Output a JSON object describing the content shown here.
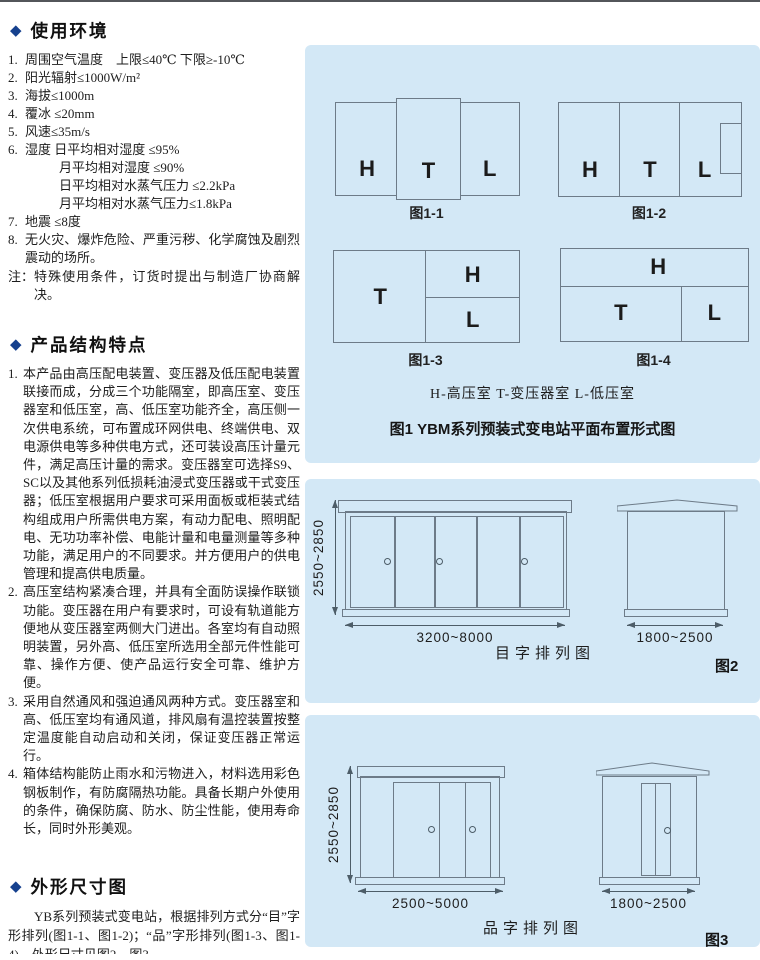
{
  "env": {
    "heading": "使用环境",
    "items": [
      {
        "no": "1.",
        "text": "周围空气温度　上限≤40℃ 下限≥-10℃"
      },
      {
        "no": "2.",
        "text": "阳光辐射≤1000W/m²"
      },
      {
        "no": "3.",
        "text": "海拔≤1000m"
      },
      {
        "no": "4.",
        "text": "覆冰 ≤20mm"
      },
      {
        "no": "5.",
        "text": "风速≤35m/s"
      },
      {
        "no": "6.",
        "text": "湿度 日平均相对湿度 ≤95%"
      },
      {
        "no": "",
        "text": "月平均相对湿度 ≤90%"
      },
      {
        "no": "",
        "text": "日平均相对水蒸气压力 ≤2.2kPa"
      },
      {
        "no": "",
        "text": "月平均相对水蒸气压力≤1.8kPa"
      },
      {
        "no": "7.",
        "text": "地震 ≤8度"
      },
      {
        "no": "8.",
        "text": "无火灾、爆炸危险、严重污秽、化学腐蚀及剧烈震动的场所。"
      }
    ],
    "note_label": "注：",
    "note_text": "特殊使用条件，订货时提出与制造厂协商解决。"
  },
  "features": {
    "heading": "产品结构特点",
    "items": [
      {
        "no": "1.",
        "text": "本产品由高压配电装置、变压器及低压配电装置联接而成，分成三个功能隔室，即高压室、变压器室和低压室，高、低压室功能齐全，高压侧一次供电系统，可布置成环网供电、终端供电、双电源供电等多种供电方式，还可装设高压计量元件，满足高压计量的需求。变压器室可选择S9、SC以及其他系列低损耗油浸式变压器或干式变压器；低压室根据用户要求可采用面板或柜装式结构组成用户所需供电方案，有动力配电、照明配电、无功功率补偿、电能计量和电量测量等多种功能，满足用户的不同要求。并方便用户的供电管理和提高供电质量。"
      },
      {
        "no": "2.",
        "text": "高压室结构紧凑合理，并具有全面防误操作联锁功能。变压器在用户有要求时，可设有轨道能方便地从变压器室两侧大门进出。各室均有自动照明装置，另外高、低压室所选用全部元件性能可靠、操作方便、使产品运行安全可靠、维护方便。"
      },
      {
        "no": "3.",
        "text": "采用自然通风和强迫通风两种方式。变压器室和高、低压室均有通风道，排风扇有温控装置按整定温度能自动启动和关闭，保证变压器正常运行。"
      },
      {
        "no": "4.",
        "text": "箱体结构能防止雨水和污物进入，材料选用彩色钢板制作，有防腐隔热功能。具备长期户外使用的条件，确保防腐、防水、防尘性能，使用寿命长，同时外形美观。"
      }
    ]
  },
  "outline": {
    "heading": "外形尺寸图",
    "paragraph": "YB系列预装式变电站，根据排列方式分“目”字形排列(图1-1、图1-2)；“品”字形排列(图1-3、图1-4)。外形尺寸见图2、图3。"
  },
  "fig1": {
    "rooms": {
      "h": "H",
      "t": "T",
      "l": "L"
    },
    "captions": [
      "图1-1",
      "图1-2",
      "图1-3",
      "图1-4"
    ],
    "legend": "H-高压室  T-变压器室  L-低压室",
    "title": "图1  YBM系列预装式变电站平面布置形式图"
  },
  "fig2": {
    "height_dim": "2550~2850",
    "width_dim": "3200~8000",
    "side_width_dim": "1800~2500",
    "caption": "目字排列图",
    "fig_label": "图2"
  },
  "fig3": {
    "height_dim": "2550~2850",
    "width_dim": "2500~5000",
    "side_width_dim": "1800~2500",
    "caption": "品字排列图",
    "fig_label": "图3"
  },
  "colors": {
    "panel_bg": "#d3e8f6",
    "accent": "#16418e",
    "drawing_line": "#6d7b88"
  }
}
